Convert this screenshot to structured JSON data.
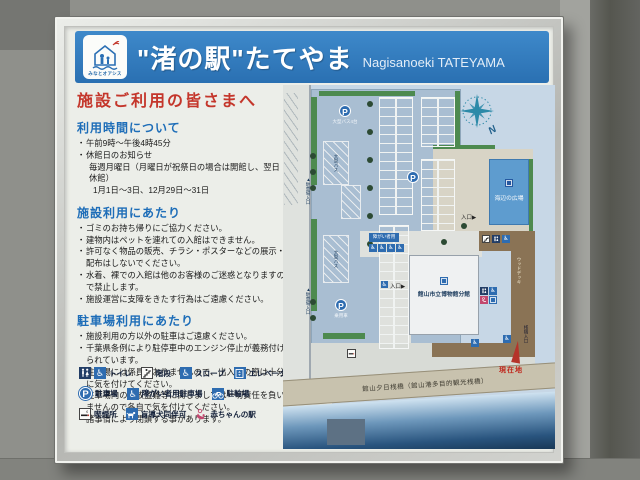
{
  "header": {
    "logo_text": "みなとオアシス",
    "title": "\"渚の駅\"たてやま",
    "subtitle": "Nagisanoeki TATEYAMA"
  },
  "notice": {
    "title": "施設ご利用の皆さまへ",
    "hours": {
      "heading": "利用時間について",
      "lines": [
        "午前9時～午後4時45分",
        "休館日のお知らせ",
        "毎週月曜日（月曜日が祝祭日の場合は開館し、翌日休館）",
        "1月1日～3日、12月29日～31日"
      ]
    },
    "facility": {
      "heading": "施設利用にあたり",
      "lines": [
        "ゴミのお持ち帰りにご協力ください。",
        "建物内はペットを連れての入館はできません。",
        "許可なく物品の販売、チラシ・ポスターなどの展示・配布はしないでください。",
        "水着、裸での入館は他のお客様のご迷惑となりますので禁止します。",
        "施設運営に支障をきたす行為はご遠慮ください。"
      ]
    },
    "parking": {
      "heading": "駐車場利用にあたり",
      "lines": [
        "施設利用の方以外の駐車はご遠慮ください。",
        "千葉県条例により駐停車中のエンジン停止が義務付けられています。",
        "駐車場には係員がおりませんので、出入りの際は十分に気を付けてください。",
        "駐車場内の事故盗難等に関しましては一切責任を負いませんので各自で気を付けてください。",
        "諸事情により閉鎖する事があります。"
      ]
    }
  },
  "legend": {
    "items": [
      {
        "icon": "toilet-icon",
        "label": "トイレ"
      },
      {
        "icon": "stairs-icon",
        "label": "階段"
      },
      {
        "icon": "slope-icon",
        "label": "スロープ"
      },
      {
        "icon": "elevator-icon",
        "label": "エレベーター"
      },
      {
        "icon": "parking-icon",
        "label": "駐車場"
      },
      {
        "icon": "accessible-parking-icon",
        "label": "障がい者用駐車場"
      },
      {
        "icon": "bicycle-icon",
        "label": "駐輪場"
      },
      {
        "icon": "smoking-icon",
        "label": "喫煙所"
      },
      {
        "icon": "guide-dog-icon",
        "label": "盲導犬同伴可"
      },
      {
        "icon": "baby-icon",
        "label": "赤ちゃんの駅"
      }
    ]
  },
  "map": {
    "compass_n": "N",
    "p1_label": "大型バス4台",
    "p3_label": "乗用車",
    "bus_stall_label": "大型バス",
    "lot_entrance_label_1": "駐車場入口",
    "lot_entrance_label_2": "駐車場入口",
    "accessible_sign": "障がい者用",
    "building_plaza": "海辺の広場",
    "building_museum": "館山市立博物館分館",
    "entrance_label": "入口",
    "deck_label": "ウッドデッキ",
    "pier_label": "館山夕日桟橋（館山港多目的観光桟橋）",
    "pier_entrance_label": "桟橋入口",
    "current_location": "現在地"
  },
  "icons": {
    "parking_p": "P",
    "wheelchair": "♿",
    "arrow_right": "▶",
    "arrow_up": "▲"
  },
  "colors": {
    "header_blue": "#2e7cc0",
    "accent_red": "#c4362b",
    "heading_blue": "#1d6db8",
    "sea_blue": "#29547e",
    "deck_brown": "#8a7355"
  }
}
